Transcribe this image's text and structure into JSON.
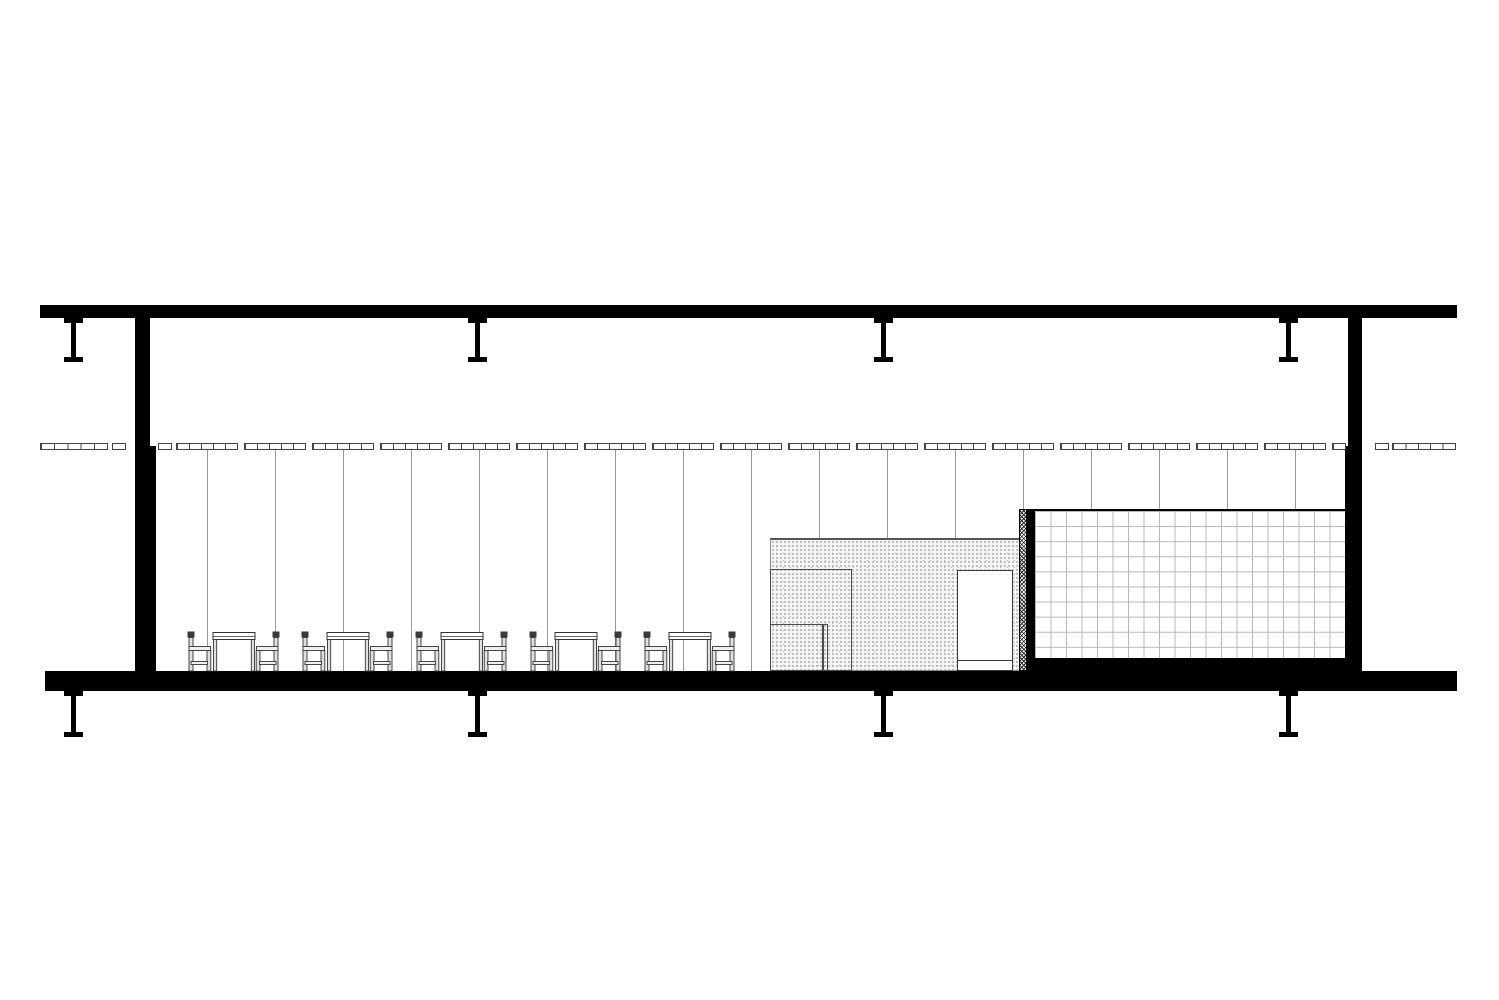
{
  "document": {
    "type": "architectural-section-drawing",
    "description": "Long-span pavilion building section: roof slab with hanger beams, two steel columns, suspended ceiling panel grid, curtain mullion lines, five table-and-chair groups, stippled service core with door, hatched partition and tiled wall volume over a floor slab with beams below"
  },
  "colors": {
    "ink": "#000000",
    "paper": "#ffffff",
    "panel_stroke": "#444444",
    "mullion_gray": "#9a9a9a",
    "tile_gray": "#b8b8b8",
    "furniture_stroke": "#333333",
    "stipple_bg": "#f5f5f5"
  },
  "drawing": {
    "canvas": {
      "w": 1499,
      "h": 1000
    },
    "roof_slab": {
      "x": 40,
      "y": 305,
      "w": 1417,
      "h": 13
    },
    "floor_slab": {
      "x": 45,
      "y": 671,
      "w": 1412,
      "h": 20
    },
    "top_hangers": {
      "centers": [
        73,
        477,
        883,
        1288
      ],
      "y": 318,
      "web_w": 5,
      "web_h": 39,
      "flange_w": 19,
      "flange_h": 5
    },
    "bottom_hangers": {
      "centers": [
        73,
        477,
        883,
        1288
      ],
      "y": 691,
      "web_w": 5,
      "web_h": 41,
      "flange_w": 19,
      "flange_h": 5
    },
    "columns": {
      "left": {
        "upper": {
          "x": 135,
          "y": 318,
          "w": 15,
          "h": 128
        },
        "lower": {
          "x": 135,
          "y": 446,
          "w": 21,
          "h": 225
        }
      },
      "right": {
        "upper": {
          "x": 1348,
          "y": 318,
          "w": 14,
          "h": 128
        },
        "lower": {
          "x": 1345,
          "y": 446,
          "w": 17,
          "h": 225
        }
      }
    },
    "ceiling": {
      "y": 443,
      "h": 7,
      "cells": 5,
      "outside_left": [
        {
          "x": 40,
          "w": 68,
          "cells": 5
        },
        {
          "x": 112,
          "w": 14,
          "cells": 1
        }
      ],
      "outside_right": [
        {
          "x": 1375,
          "w": 14,
          "cells": 1
        },
        {
          "x": 1392,
          "w": 64,
          "cells": 5
        }
      ],
      "interior": {
        "single": {
          "x": 158,
          "w": 14
        },
        "group_start": 176,
        "group_step": 68,
        "group_w": 62,
        "clip_x": 156,
        "clip_right": 1346
      }
    },
    "curtain_lines": {
      "y_top": 450,
      "center_offset": 31,
      "max_center": 1310,
      "bottoms": [
        {
          "below_x": 772,
          "y": 671
        },
        {
          "below_x": 1016,
          "y": 538
        },
        {
          "below_x": 1346,
          "y": 509
        }
      ]
    },
    "core_volume": {
      "x": 770,
      "y": 538,
      "w": 250,
      "h": 133,
      "inner_rect_a": {
        "x": 770,
        "y": 569,
        "w": 82,
        "h": 102
      },
      "inner_rect_b": {
        "x": 770,
        "y": 624,
        "w": 58,
        "h": 47,
        "double_line_x": 822
      },
      "door": {
        "x": 957,
        "y": 570,
        "w": 56,
        "h": 101,
        "threshold_from_bottom": 9
      }
    },
    "hatch_strip": {
      "x": 1019,
      "y": 509,
      "w": 8,
      "h": 162
    },
    "black_strip": {
      "x": 1027,
      "y": 509,
      "w": 8,
      "h": 162
    },
    "tile_wall": {
      "x": 1035,
      "y": 509,
      "w": 310,
      "h": 151,
      "base_y": 658,
      "base_h": 13
    },
    "furniture": {
      "y": 630,
      "w": 93,
      "h": 41,
      "xs": [
        187,
        301,
        415,
        529,
        643
      ]
    }
  }
}
